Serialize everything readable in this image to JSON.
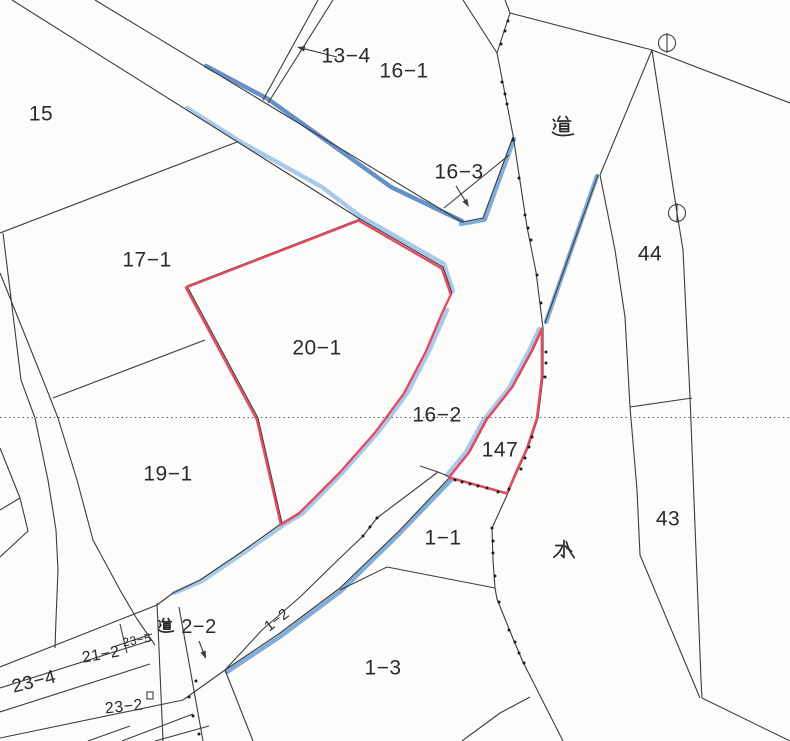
{
  "map": {
    "palette": {
      "paper": "#fcfcfa",
      "line": "#3c3c3c",
      "dotted": "#4a4a4a",
      "dot": "#1c1c1c",
      "red": "#e8495f",
      "blue_dark": "#4a7dc0",
      "blue_mid": "#6b9dd4",
      "blue_light": "#93bce6",
      "label": "#2a2a2a"
    },
    "labels": [
      {
        "id": "parcel-15",
        "text": "15",
        "x": 41,
        "y": 114,
        "size": 21
      },
      {
        "id": "parcel-13-4",
        "text": "13−4",
        "x": 346,
        "y": 56,
        "size": 21
      },
      {
        "id": "parcel-16-1",
        "text": "16−1",
        "x": 404,
        "y": 71,
        "size": 21
      },
      {
        "id": "road-label-top",
        "text": "道",
        "x": 563,
        "y": 127,
        "size": 24,
        "glyph": "michi"
      },
      {
        "id": "parcel-16-3",
        "text": "16−3",
        "x": 459,
        "y": 172,
        "size": 21
      },
      {
        "id": "parcel-44",
        "text": "44",
        "x": 650,
        "y": 254,
        "size": 21
      },
      {
        "id": "parcel-17-1",
        "text": "17−1",
        "x": 147,
        "y": 260,
        "size": 21
      },
      {
        "id": "parcel-20-1",
        "text": "20−1",
        "x": 317,
        "y": 348,
        "size": 21
      },
      {
        "id": "parcel-16-2",
        "text": "16−2",
        "x": 437,
        "y": 415,
        "size": 21
      },
      {
        "id": "parcel-147",
        "text": "147",
        "x": 500,
        "y": 450,
        "size": 21
      },
      {
        "id": "parcel-19-1",
        "text": "19−1",
        "x": 168,
        "y": 474,
        "size": 21
      },
      {
        "id": "parcel-43",
        "text": "43",
        "x": 668,
        "y": 519,
        "size": 21
      },
      {
        "id": "parcel-1-1",
        "text": "1−1",
        "x": 443,
        "y": 538,
        "size": 21
      },
      {
        "id": "water-label",
        "text": "水",
        "x": 564,
        "y": 551,
        "size": 24,
        "glyph": "mizu"
      },
      {
        "id": "road-label-bottom",
        "text": "道",
        "x": 166,
        "y": 626,
        "size": 17,
        "glyph": "michi"
      },
      {
        "id": "parcel-2-2",
        "text": "2−2",
        "x": 199,
        "y": 627,
        "size": 20
      },
      {
        "id": "parcel-1-2",
        "text": "1−2",
        "x": 277,
        "y": 620,
        "size": 15,
        "rotate": -38
      },
      {
        "id": "parcel-23-5",
        "text": "23−5",
        "x": 137,
        "y": 640,
        "size": 12,
        "rotate": -10
      },
      {
        "id": "parcel-21-2",
        "text": "21−2",
        "x": 101,
        "y": 655,
        "size": 16,
        "rotate": -10
      },
      {
        "id": "parcel-23-4",
        "text": "23−4",
        "x": 34,
        "y": 682,
        "size": 19,
        "rotate": -14
      },
      {
        "id": "parcel-23-2",
        "text": "23−2",
        "x": 124,
        "y": 707,
        "size": 16,
        "rotate": -6
      },
      {
        "id": "parcel-1-3",
        "text": "1−3",
        "x": 383,
        "y": 668,
        "size": 21
      }
    ],
    "circle_markers": [
      {
        "cx": 667,
        "cy": 43,
        "r": 8.5
      },
      {
        "cx": 677,
        "cy": 213,
        "r": 8.5
      }
    ],
    "square_marker": {
      "x": 147,
      "y": 692,
      "w": 6,
      "h": 7
    },
    "arrows": [
      {
        "id": "arrow-13-4",
        "x1": 337,
        "y1": 57,
        "x2": 297,
        "y2": 47
      },
      {
        "id": "arrow-16-3",
        "x1": 456,
        "y1": 186,
        "x2": 469,
        "y2": 207
      },
      {
        "id": "arrow-2-2",
        "x1": 199,
        "y1": 641,
        "x2": 206,
        "y2": 659
      }
    ],
    "dot_chains": {
      "road_west_boundary": [
        [
          508,
          21
        ],
        [
          505,
          31
        ],
        [
          501,
          44
        ],
        [
          502,
          82
        ],
        [
          505,
          94
        ],
        [
          507,
          104
        ],
        [
          513,
          140
        ],
        [
          519,
          178
        ],
        [
          525,
          215
        ],
        [
          528,
          228
        ],
        [
          531,
          240
        ],
        [
          537,
          275
        ],
        [
          541,
          303
        ]
      ],
      "parcel_147_edge": [
        [
          546,
          352
        ],
        [
          546,
          363
        ],
        [
          545,
          377
        ],
        [
          532,
          437
        ],
        [
          529,
          447
        ],
        [
          525,
          458
        ],
        [
          521,
          469
        ],
        [
          509,
          489
        ],
        [
          498,
          492
        ],
        [
          487,
          488
        ],
        [
          478,
          486
        ],
        [
          470,
          484
        ],
        [
          462,
          482
        ],
        [
          455,
          480
        ]
      ],
      "water_west_boundary": [
        [
          492,
          528
        ],
        [
          493,
          541
        ],
        [
          493,
          553
        ],
        [
          495,
          576
        ],
        [
          499,
          602
        ],
        [
          509,
          630
        ],
        [
          515,
          642
        ],
        [
          519,
          653
        ],
        [
          524,
          663
        ]
      ],
      "strip_1_2": [
        [
          363,
          536
        ],
        [
          370,
          527
        ],
        [
          377,
          518
        ]
      ],
      "parcel_2_2_south": [
        [
          196,
          681
        ],
        [
          189,
          697
        ],
        [
          193,
          716
        ],
        [
          199,
          734
        ]
      ]
    }
  }
}
